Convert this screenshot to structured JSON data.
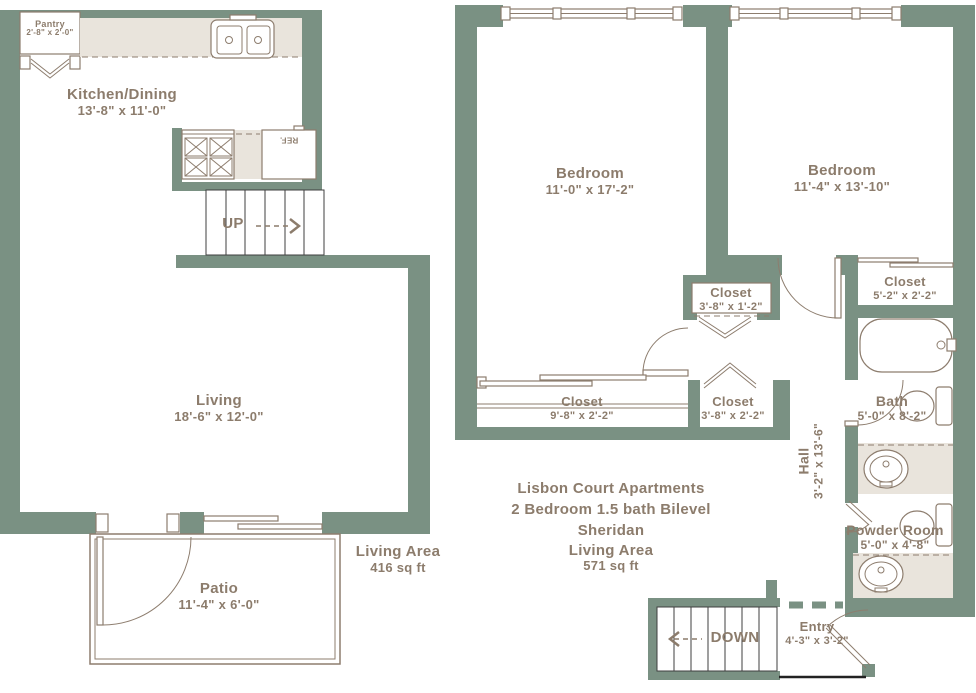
{
  "palette": {
    "wall": "#7A9183",
    "line": "#8D7D6E",
    "counter": "#E9E4DC",
    "text": "#8C7C6C",
    "stairs": "#3F3F3F"
  },
  "title_block": {
    "line1": "Lisbon Court Apartments",
    "line2": "2 Bedroom 1.5 bath Bilevel",
    "line3": "Sheridan",
    "area_label": "Living Area",
    "area_value": "571 sq ft"
  },
  "lower_area": {
    "area_label": "Living Area",
    "area_value": "416 sq ft"
  },
  "rooms": {
    "pantry": {
      "name": "Pantry",
      "dims": "2'-8\" x 2'-0\""
    },
    "kitchen_dining": {
      "name": "Kitchen/Dining",
      "dims": "13'-8\" x 11'-0\""
    },
    "living": {
      "name": "Living",
      "dims": "18'-6\" x 12'-0\""
    },
    "patio": {
      "name": "Patio",
      "dims": "11'-4\" x 6'-0\""
    },
    "bedroom_left": {
      "name": "Bedroom",
      "dims": "11'-0\" x 17'-2\""
    },
    "bedroom_right": {
      "name": "Bedroom",
      "dims": "11'-4\" x 13'-10\""
    },
    "closet_middle": {
      "name": "Closet",
      "dims": "3'-8\" x 1'-2\""
    },
    "closet_right": {
      "name": "Closet",
      "dims": "5'-2\" x 2'-2\""
    },
    "closet_long": {
      "name": "Closet",
      "dims": "9'-8\" x 2'-2\""
    },
    "closet_small": {
      "name": "Closet",
      "dims": "3'-8\" x 2'-2\""
    },
    "bath": {
      "name": "Bath",
      "dims": "5'-0\" x 8'-2\""
    },
    "hall": {
      "name": "Hall",
      "dims": "3'-2\" x 13'-6\""
    },
    "powder_room": {
      "name": "Powder Room",
      "dims": "5'-0\" x 4'-8\""
    },
    "entry": {
      "name": "Entry",
      "dims": "4'-3\" x 3'-2\""
    }
  },
  "stairs": {
    "up": "UP",
    "down": "DOWN"
  },
  "appliances": {
    "refrigerator": "REF."
  }
}
